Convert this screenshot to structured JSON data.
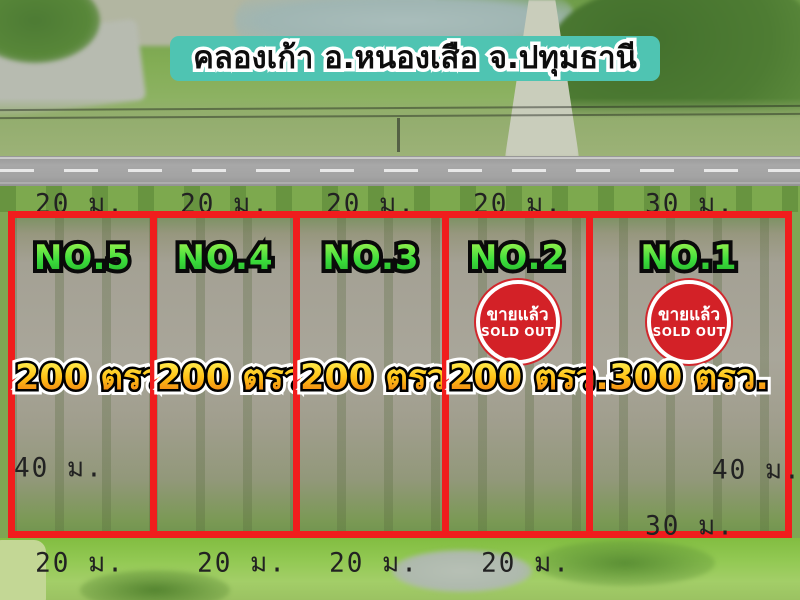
{
  "title": "คลองเก้า อ.หนองเสือ จ.ปทุมธานี",
  "plots": [
    {
      "id": "no5",
      "name": "NO.5",
      "area": "200 ตรว.",
      "road_frontage": "20 ม.",
      "bottom_width": "20 ม.",
      "sold": false
    },
    {
      "id": "no4",
      "name": "NO.4",
      "area": "200 ตรว.",
      "road_frontage": "20 ม.",
      "bottom_width": "20 ม.",
      "sold": false
    },
    {
      "id": "no3",
      "name": "NO.3",
      "area": "200 ตรว.",
      "road_frontage": "20 ม.",
      "bottom_width": "20 ม.",
      "sold": false
    },
    {
      "id": "no2",
      "name": "NO.2",
      "area": "200 ตรว.",
      "road_frontage": "20 ม.",
      "bottom_width": "20 ม.",
      "sold": true
    },
    {
      "id": "no1",
      "name": "NO.1",
      "area": "300 ตรว.",
      "road_frontage": "30 ม.",
      "bottom_width": "30 ม.",
      "sold": true
    }
  ],
  "sold_badge": {
    "thai": "ขายแล้ว",
    "english": "SOLD OUT"
  },
  "depth_labels": {
    "left": "40 ม.",
    "right": "40 ม."
  },
  "colors": {
    "banner_bg": "#4fc4b2",
    "plot_border_red": "#f01d1d",
    "plot_name_green": "#3bdc3b",
    "area_text_gold": "#ffc116",
    "sold_badge_red": "#d32127",
    "dimension_text": "#222222"
  }
}
